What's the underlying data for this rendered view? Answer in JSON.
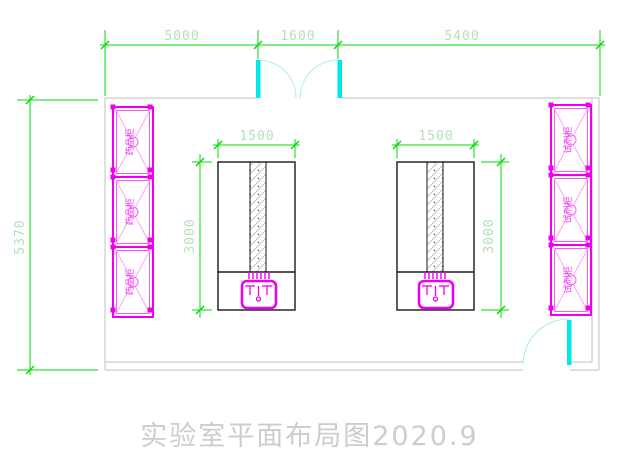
{
  "title": "实验室平面布局图2020.9",
  "dims": {
    "top": {
      "left": "5000",
      "middle": "1600",
      "right": "5400"
    },
    "overall_height": "5370",
    "left_bench": {
      "width": "1500",
      "depth": "3000"
    },
    "right_bench": {
      "width": "1500",
      "depth": "3000"
    }
  },
  "cabinets": {
    "left_label": "药品柜",
    "right_label": "试剂柜"
  },
  "colors": {
    "dimension_line": "#00dd00",
    "dimension_text": "#b4e2b4",
    "wall": "#cccccc",
    "door": "#00e8e8",
    "door_arc": "#a8ecec",
    "furniture": "#ee00ee",
    "bench_outline": "#1a1a1a",
    "title_text": "#cdcdcd"
  }
}
